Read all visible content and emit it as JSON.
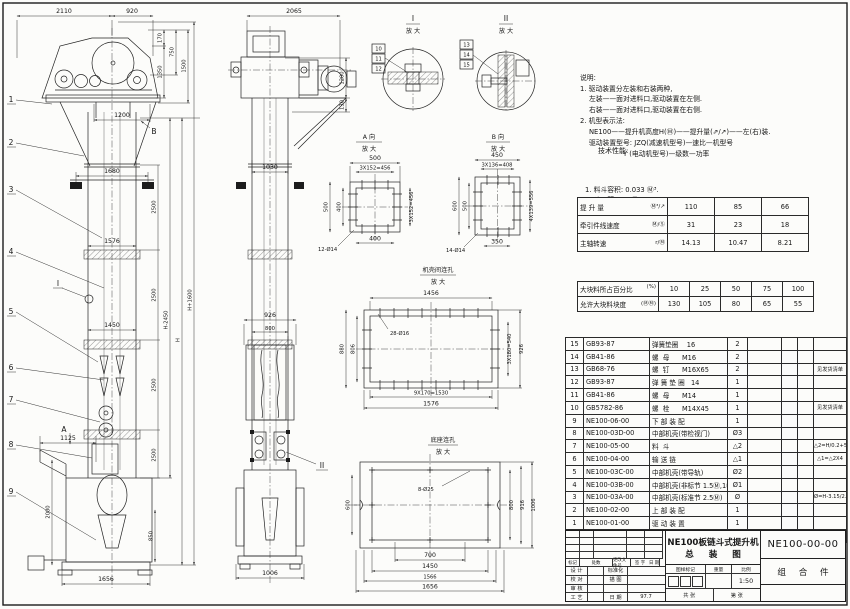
{
  "notes": {
    "lines": [
      "说明:",
      "1. 驱动装置分左装和右装两种,",
      "　 左装——面对进料口,驱动装置在左侧.",
      "　 右装——面对进料口,驱动装置在右侧.",
      "2. 机型表示法:",
      "　 NE100——提升机高度H(Ⓜ)——提升量(⇗/↗)——左(右)装.",
      "　 驱动装置型号: JZQ(减速机型号)—速比—机型号",
      "　 　　　　　Y (电动机型号)—级数—功率"
    ]
  },
  "tech": {
    "title": "技术性能:",
    "items": [
      "1. 料斗容积: 0.033 Ⓜ³.",
      "2. 斗　距: 0.4 Ⓜ.",
      "3. 斗　宽: 0.4 Ⓜ.",
      "4. 提升量,牵引件线速度和主轴转速:"
    ],
    "table1": {
      "rows": [
        {
          "label": "提 升 量",
          "unit": "Ⓜ³/↗",
          "v1": "110",
          "v2": "85",
          "v3": "66"
        },
        {
          "label": "牵引件线速度",
          "unit": "Ⓜ/Ⓢ",
          "v1": "31",
          "v2": "23",
          "v3": "18"
        },
        {
          "label": "主轴转速",
          "unit": "r/Ⓜ",
          "v1": "14.13",
          "v2": "10.47",
          "v3": "8.21"
        }
      ]
    },
    "items2": [
      "5. 填充系数按 0.7计算.",
      "6. 牵引件安全系数 >1倍.",
      "7. 物料块度:"
    ],
    "table2": {
      "rows": [
        {
          "label": "大块料所占百分比",
          "unit": "(%)",
          "v1": "10",
          "v2": "25",
          "v3": "50",
          "v4": "75",
          "v5": "100"
        },
        {
          "label": "允许大块料块度",
          "unit": "(ⓂⓂ)",
          "v1": "130",
          "v2": "105",
          "v3": "80",
          "v4": "65",
          "v5": "55"
        }
      ]
    }
  },
  "bom": {
    "header": {
      "no": "序号",
      "code": "代  号",
      "name": "名  称",
      "qty": "数量",
      "material": "材  料",
      "unit": "单重",
      "total": "总重",
      "remark": "备  注"
    },
    "rows": [
      {
        "no": "15",
        "code": "GB93-87",
        "name": "弹簧垫圈    16",
        "qty": "2",
        "material": "",
        "unit": "",
        "total": "",
        "remark": ""
      },
      {
        "no": "14",
        "code": "GB41-86",
        "name": "螺  母      M16",
        "qty": "2",
        "material": "",
        "unit": "",
        "total": "",
        "remark": ""
      },
      {
        "no": "13",
        "code": "GB68-76",
        "name": "螺  钉      M16X65",
        "qty": "2",
        "material": "",
        "unit": "",
        "total": "",
        "remark": "见发货清单"
      },
      {
        "no": "12",
        "code": "GB93-87",
        "name": "弹 簧 垫 圈   14",
        "qty": "1",
        "material": "",
        "unit": "",
        "total": "",
        "remark": ""
      },
      {
        "no": "11",
        "code": "GB41-86",
        "name": "螺  母      M14",
        "qty": "1",
        "material": "",
        "unit": "",
        "total": "",
        "remark": ""
      },
      {
        "no": "10",
        "code": "GB5782-86",
        "name": "螺  栓      M14X45",
        "qty": "1",
        "material": "",
        "unit": "",
        "total": "",
        "remark": "见发货清单"
      },
      {
        "no": "9",
        "code": "NE100-06-00",
        "name": "下 部 装 配",
        "qty": "1",
        "material": "",
        "unit": "",
        "total": "",
        "remark": ""
      },
      {
        "no": "8",
        "code": "NE100-03D-00",
        "name": "中部机壳(带检视门)",
        "qty": "Ø3",
        "material": "",
        "unit": "",
        "total": "",
        "remark": ""
      },
      {
        "no": "7",
        "code": "NE100-05-00",
        "name": "料  斗",
        "qty": "△2",
        "material": "",
        "unit": "",
        "total": "",
        "remark": "△2=H/0.2+5.75"
      },
      {
        "no": "6",
        "code": "NE100-04-00",
        "name": "输 送 链",
        "qty": "△1",
        "material": "",
        "unit": "",
        "total": "",
        "remark": "△1=△2X4"
      },
      {
        "no": "5",
        "code": "NE100-03C-00",
        "name": "中部机壳(带导轨)",
        "qty": "Ø2",
        "material": "",
        "unit": "",
        "total": "",
        "remark": ""
      },
      {
        "no": "4",
        "code": "NE100-03B-00",
        "name": "中部机壳(非标节 1.5Ⓜ,1Ⓜ)",
        "qty": "Ø1",
        "material": "",
        "unit": "",
        "total": "",
        "remark": ""
      },
      {
        "no": "3",
        "code": "NE100-03A-00",
        "name": "中部机壳(标准节 2.5Ⓜ)",
        "qty": "Ø",
        "material": "",
        "unit": "",
        "total": "",
        "remark": "Ø=H-3.15/2.5"
      },
      {
        "no": "2",
        "code": "NE100-02-00",
        "name": "上 部 装 配",
        "qty": "1",
        "material": "",
        "unit": "",
        "total": "",
        "remark": ""
      },
      {
        "no": "1",
        "code": "NE100-01-00",
        "name": "驱 动 装 置",
        "qty": "1",
        "material": "",
        "unit": "",
        "total": "",
        "remark": ""
      }
    ]
  },
  "title_block": {
    "rev_cols": [
      "标记",
      "处数",
      "更改文件号",
      "签 字",
      "日 期"
    ],
    "roles": [
      {
        "l": "设 计",
        "r": "标准化",
        "d": ""
      },
      {
        "l": "校 对",
        "r": "描 图",
        "d": ""
      },
      {
        "l": "审 核",
        "r": "",
        "d": ""
      },
      {
        "l": "工 艺",
        "r": "日 期",
        "d": "97.7"
      }
    ],
    "title1": "NE100板链斗式提升机",
    "title2": "总 装 图",
    "mark_label": "图样标记",
    "weight_label": "重量",
    "scale_label": "比例",
    "scale": "1:50",
    "sheets": "共  张",
    "sheet_no": "第  张",
    "code": "NE100-00-00",
    "kind": "组 合 件"
  },
  "views": {
    "left_view": {
      "balloons": [
        "1",
        "2",
        "3",
        "4",
        "5",
        "6",
        "7",
        "8",
        "9"
      ],
      "d2110": "2110",
      "d920": "920",
      "d170": "170",
      "d750": "750",
      "d1350": "1350",
      "d1500": "1500",
      "d1200": "1200",
      "d1680": "1680",
      "d2500": "2500",
      "d1576": "1576",
      "d1450": "1450",
      "d1125": "1125",
      "d2000": "2000",
      "d850": "850",
      "d1656": "1656",
      "dH2450": "H-2450",
      "dH": "H",
      "dH1600": "H+1600",
      "sec_a": "A",
      "sec_b": "B",
      "sec_i": "I"
    },
    "side_view": {
      "d2065": "2065",
      "d1200": "1200",
      "d130": "130",
      "d1030": "1030",
      "d926": "926",
      "d800": "800",
      "d1006": "1006",
      "sec_ii": "II"
    },
    "detail_i": {
      "label": "I",
      "mag": "放 大",
      "balloons": [
        "10",
        "11",
        "12"
      ]
    },
    "detail_ii": {
      "label": "II",
      "mag": "放 大",
      "balloons": [
        "13",
        "14",
        "15"
      ]
    },
    "view_a": {
      "label": "A 向",
      "mag": "放 大",
      "d500t": "500",
      "d456t": "3X152=456",
      "d500l": "500",
      "d400l": "400",
      "d456r": "3X152=456",
      "d400b": "400",
      "holes": "12-Ø14"
    },
    "view_b": {
      "label": "B 向",
      "mag": "放 大",
      "d450": "450",
      "d408": "3X136=408",
      "d600": "600",
      "d500": "500",
      "d556": "4X139=556",
      "d350": "350",
      "holes": "14-Ø14"
    },
    "casing_holes": {
      "label": "机壳间连孔",
      "mag": "放 大",
      "d1456": "1456",
      "d880": "880",
      "d806": "806",
      "holes": "28-Ø16",
      "d540": "3X180=540",
      "d926": "926",
      "d1530": "9X170=1530",
      "d1576": "1576"
    },
    "base_holes": {
      "label": "底座连孔",
      "mag": "放 大",
      "d600": "600",
      "holes": "8-Ø25",
      "d800": "800",
      "d916": "916",
      "d1006": "1006",
      "d700": "700",
      "d1450": "1450",
      "d1566": "1566",
      "d1656": "1656"
    }
  }
}
